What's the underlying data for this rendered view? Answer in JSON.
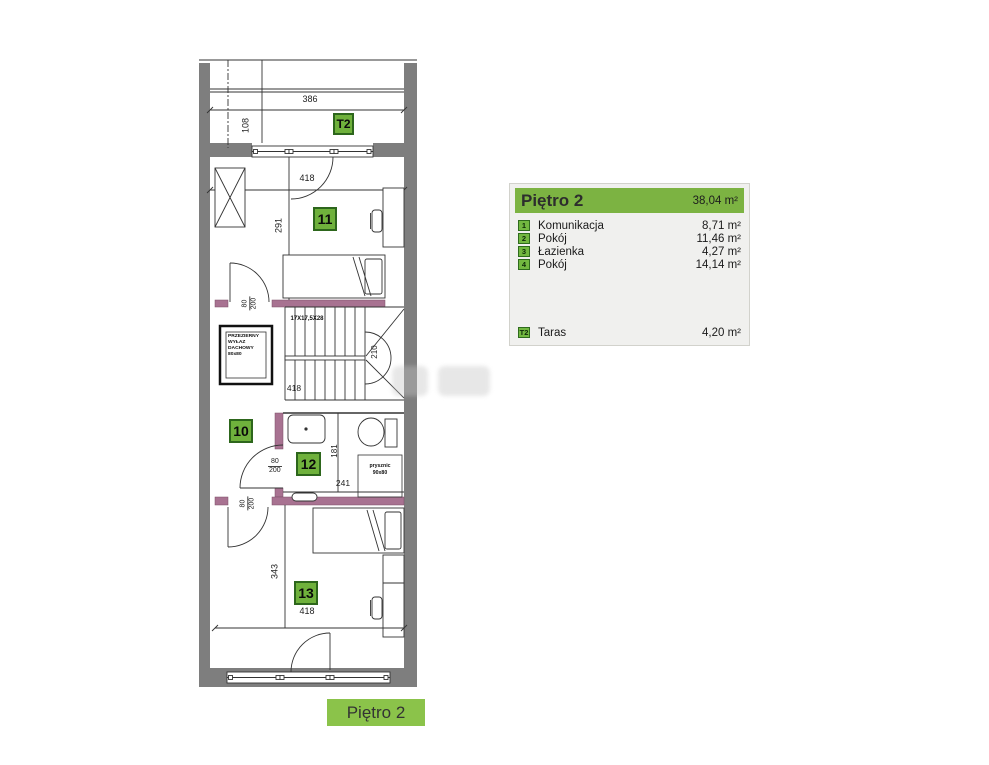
{
  "legend": {
    "title": "Piętro 2",
    "total_area": "38,04 m²",
    "rows": [
      {
        "no": "1",
        "name": "Komunikacja",
        "area": "8,71 m²"
      },
      {
        "no": "2",
        "name": "Pokój",
        "area": "11,46 m²"
      },
      {
        "no": "3",
        "name": "Łazienka",
        "area": "4,27 m²"
      },
      {
        "no": "4",
        "name": "Pokój",
        "area": "14,14 m²"
      }
    ],
    "terrace_row": {
      "no": "T2",
      "name": "Taras",
      "area": "4,20 m²"
    }
  },
  "caption": "Piętro 2",
  "plan": {
    "badges": {
      "terrace": "T2",
      "room11": "11",
      "room10": "10",
      "room12": "12",
      "room13": "13"
    },
    "dims": {
      "terrace_width": "386",
      "terrace_depth": "108",
      "room11_width": "418",
      "room11_height": "291",
      "stairs_width": "418",
      "stairs_height": "210",
      "bath_height": "181",
      "bath_width": "241",
      "room13_height": "343",
      "room13_width": "418",
      "door_width": "80",
      "door_height": "200"
    },
    "stairs_label": "17X17,5X28",
    "skylight": {
      "line1": "PRZEZIERNY",
      "line2": "WYŁAZ",
      "line3": "DACHOWY",
      "line4": "80x80"
    },
    "shower": {
      "line1": "prysznic",
      "line2": "90x80"
    }
  },
  "colors": {
    "legend_green": "#7cb342",
    "caption_green": "#8bc34a",
    "badge_green": "#6fb13c",
    "badge_border_green": "#2d661c",
    "wall_grey": "#7e7e7e",
    "wall_purple": "#a87291",
    "panel_background": "#f0f0ee"
  }
}
